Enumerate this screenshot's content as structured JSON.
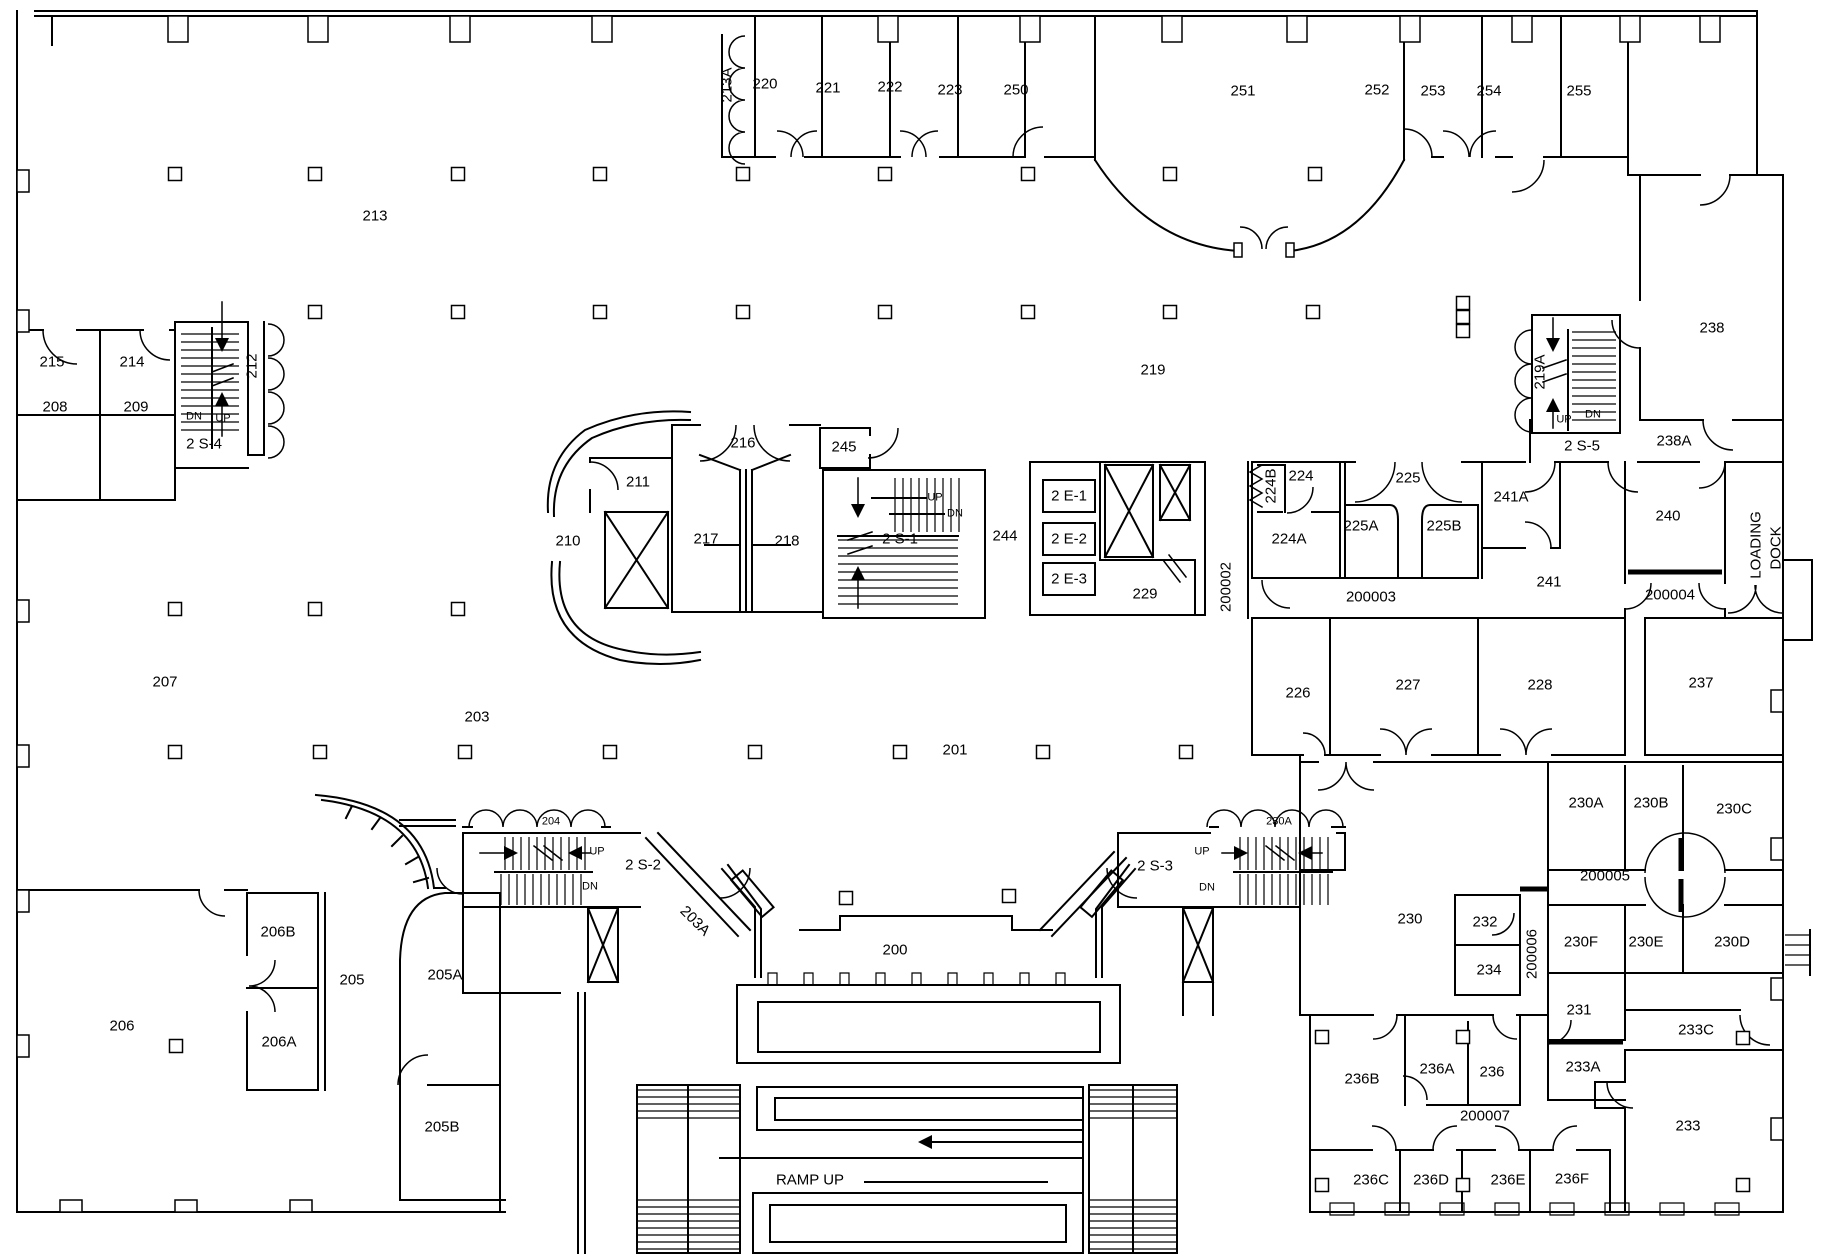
{
  "drawing": {
    "type": "architectural-floor-plan",
    "floor": "2",
    "background_color": "#ffffff",
    "line_color": "#000000",
    "annotations": {
      "ramp_label": "RAMP UP",
      "loading_dock_line1": "LOADING",
      "loading_dock_line2": "DOCK"
    },
    "stairwells": [
      "2 S-1",
      "2 S-2",
      "2 S-3",
      "2 S-4",
      "2 S-5"
    ],
    "elevators": [
      "2 E-1",
      "2 E-2",
      "2 E-3"
    ],
    "corridors": [
      "200002",
      "200003",
      "200004",
      "200005",
      "200006",
      "200007"
    ]
  },
  "labels": [
    {
      "t": "213A",
      "x": 727,
      "y": 85,
      "rot": -90
    },
    {
      "t": "220",
      "x": 765,
      "y": 84
    },
    {
      "t": "221",
      "x": 828,
      "y": 88
    },
    {
      "t": "222",
      "x": 890,
      "y": 87
    },
    {
      "t": "223",
      "x": 950,
      "y": 90
    },
    {
      "t": "250",
      "x": 1016,
      "y": 90
    },
    {
      "t": "251",
      "x": 1243,
      "y": 91
    },
    {
      "t": "252",
      "x": 1377,
      "y": 90
    },
    {
      "t": "253",
      "x": 1433,
      "y": 91
    },
    {
      "t": "254",
      "x": 1489,
      "y": 91
    },
    {
      "t": "255",
      "x": 1579,
      "y": 91
    },
    {
      "t": "213",
      "x": 375,
      "y": 216
    },
    {
      "t": "238",
      "x": 1712,
      "y": 328
    },
    {
      "t": "215",
      "x": 52,
      "y": 362
    },
    {
      "t": "214",
      "x": 132,
      "y": 362
    },
    {
      "t": "212",
      "x": 252,
      "y": 366,
      "rot": -90
    },
    {
      "t": "219",
      "x": 1153,
      "y": 370
    },
    {
      "t": "219A",
      "x": 1540,
      "y": 372,
      "rot": -90
    },
    {
      "t": "208",
      "x": 55,
      "y": 407
    },
    {
      "t": "209",
      "x": 136,
      "y": 407
    },
    {
      "t": "DN",
      "x": 194,
      "y": 417,
      "small": true
    },
    {
      "t": "UP",
      "x": 223,
      "y": 419,
      "small": true
    },
    {
      "t": "UP",
      "x": 1564,
      "y": 420,
      "small": true
    },
    {
      "t": "DN",
      "x": 1593,
      "y": 415,
      "small": true
    },
    {
      "t": "2 S-4",
      "x": 204,
      "y": 444
    },
    {
      "t": "2 S-5",
      "x": 1582,
      "y": 446
    },
    {
      "t": "238A",
      "x": 1674,
      "y": 441
    },
    {
      "t": "216",
      "x": 743,
      "y": 443
    },
    {
      "t": "245",
      "x": 844,
      "y": 447
    },
    {
      "t": "224B",
      "x": 1271,
      "y": 486,
      "rot": -90
    },
    {
      "t": "224",
      "x": 1301,
      "y": 476
    },
    {
      "t": "225",
      "x": 1408,
      "y": 478
    },
    {
      "t": "241A",
      "x": 1511,
      "y": 497
    },
    {
      "t": "211",
      "x": 638,
      "y": 482
    },
    {
      "t": "UP",
      "x": 935,
      "y": 498,
      "small": true
    },
    {
      "t": "DN",
      "x": 955,
      "y": 514,
      "small": true
    },
    {
      "t": "2 E-1",
      "x": 1069,
      "y": 496
    },
    {
      "t": "224A",
      "x": 1289,
      "y": 539
    },
    {
      "t": "225A",
      "x": 1361,
      "y": 526
    },
    {
      "t": "225B",
      "x": 1444,
      "y": 526
    },
    {
      "t": "240",
      "x": 1668,
      "y": 516
    },
    {
      "t": "210",
      "x": 568,
      "y": 541
    },
    {
      "t": "217",
      "x": 706,
      "y": 539
    },
    {
      "t": "218",
      "x": 787,
      "y": 541
    },
    {
      "t": "2 S-1",
      "x": 900,
      "y": 539
    },
    {
      "t": "244",
      "x": 1005,
      "y": 536
    },
    {
      "t": "2 E-2",
      "x": 1069,
      "y": 539
    },
    {
      "t": "2 E-3",
      "x": 1069,
      "y": 579
    },
    {
      "t": "229",
      "x": 1145,
      "y": 594
    },
    {
      "t": "200002",
      "x": 1226,
      "y": 587,
      "rot": -90
    },
    {
      "t": "200003",
      "x": 1371,
      "y": 597
    },
    {
      "t": "241",
      "x": 1549,
      "y": 582
    },
    {
      "t": "200004",
      "x": 1670,
      "y": 595
    },
    {
      "t": "LOADING",
      "x": 1756,
      "y": 545,
      "rot": -90
    },
    {
      "t": "DOCK",
      "x": 1776,
      "y": 548,
      "rot": -90
    },
    {
      "t": "226",
      "x": 1298,
      "y": 693
    },
    {
      "t": "227",
      "x": 1408,
      "y": 685
    },
    {
      "t": "228",
      "x": 1540,
      "y": 685
    },
    {
      "t": "237",
      "x": 1701,
      "y": 683
    },
    {
      "t": "207",
      "x": 165,
      "y": 682
    },
    {
      "t": "203",
      "x": 477,
      "y": 717
    },
    {
      "t": "201",
      "x": 955,
      "y": 750
    },
    {
      "t": "230A",
      "x": 1586,
      "y": 803
    },
    {
      "t": "230B",
      "x": 1651,
      "y": 803
    },
    {
      "t": "230C",
      "x": 1734,
      "y": 809
    },
    {
      "t": "204",
      "x": 551,
      "y": 822,
      "small": true
    },
    {
      "t": "230A",
      "x": 1279,
      "y": 822,
      "small": true
    },
    {
      "t": "UP",
      "x": 597,
      "y": 852,
      "small": true
    },
    {
      "t": "2 S-2",
      "x": 643,
      "y": 865
    },
    {
      "t": "DN",
      "x": 590,
      "y": 887,
      "small": true
    },
    {
      "t": "UP",
      "x": 1202,
      "y": 852,
      "small": true
    },
    {
      "t": "2 S-3",
      "x": 1155,
      "y": 866
    },
    {
      "t": "DN",
      "x": 1207,
      "y": 888,
      "small": true
    },
    {
      "t": "200005",
      "x": 1605,
      "y": 876
    },
    {
      "t": "230",
      "x": 1410,
      "y": 919
    },
    {
      "t": "232",
      "x": 1485,
      "y": 922
    },
    {
      "t": "206B",
      "x": 278,
      "y": 932
    },
    {
      "t": "203A",
      "x": 695,
      "y": 921,
      "rot": 45
    },
    {
      "t": "205A",
      "x": 445,
      "y": 975
    },
    {
      "t": "234",
      "x": 1489,
      "y": 970
    },
    {
      "t": "200006",
      "x": 1532,
      "y": 954,
      "rot": -90
    },
    {
      "t": "230F",
      "x": 1581,
      "y": 942
    },
    {
      "t": "230E",
      "x": 1646,
      "y": 942
    },
    {
      "t": "230D",
      "x": 1732,
      "y": 942
    },
    {
      "t": "205",
      "x": 352,
      "y": 980
    },
    {
      "t": "231",
      "x": 1579,
      "y": 1010
    },
    {
      "t": "200",
      "x": 895,
      "y": 950
    },
    {
      "t": "233C",
      "x": 1696,
      "y": 1030
    },
    {
      "t": "206",
      "x": 122,
      "y": 1026
    },
    {
      "t": "206A",
      "x": 279,
      "y": 1042
    },
    {
      "t": "233A",
      "x": 1583,
      "y": 1067
    },
    {
      "t": "236B",
      "x": 1362,
      "y": 1079
    },
    {
      "t": "236A",
      "x": 1437,
      "y": 1069
    },
    {
      "t": "236",
      "x": 1492,
      "y": 1072
    },
    {
      "t": "200007",
      "x": 1485,
      "y": 1116
    },
    {
      "t": "233",
      "x": 1688,
      "y": 1126
    },
    {
      "t": "205B",
      "x": 442,
      "y": 1127
    },
    {
      "t": "236C",
      "x": 1371,
      "y": 1180
    },
    {
      "t": "236D",
      "x": 1431,
      "y": 1180
    },
    {
      "t": "236E",
      "x": 1508,
      "y": 1180
    },
    {
      "t": "236F",
      "x": 1572,
      "y": 1179
    },
    {
      "t": "RAMP UP",
      "x": 810,
      "y": 1180
    }
  ]
}
